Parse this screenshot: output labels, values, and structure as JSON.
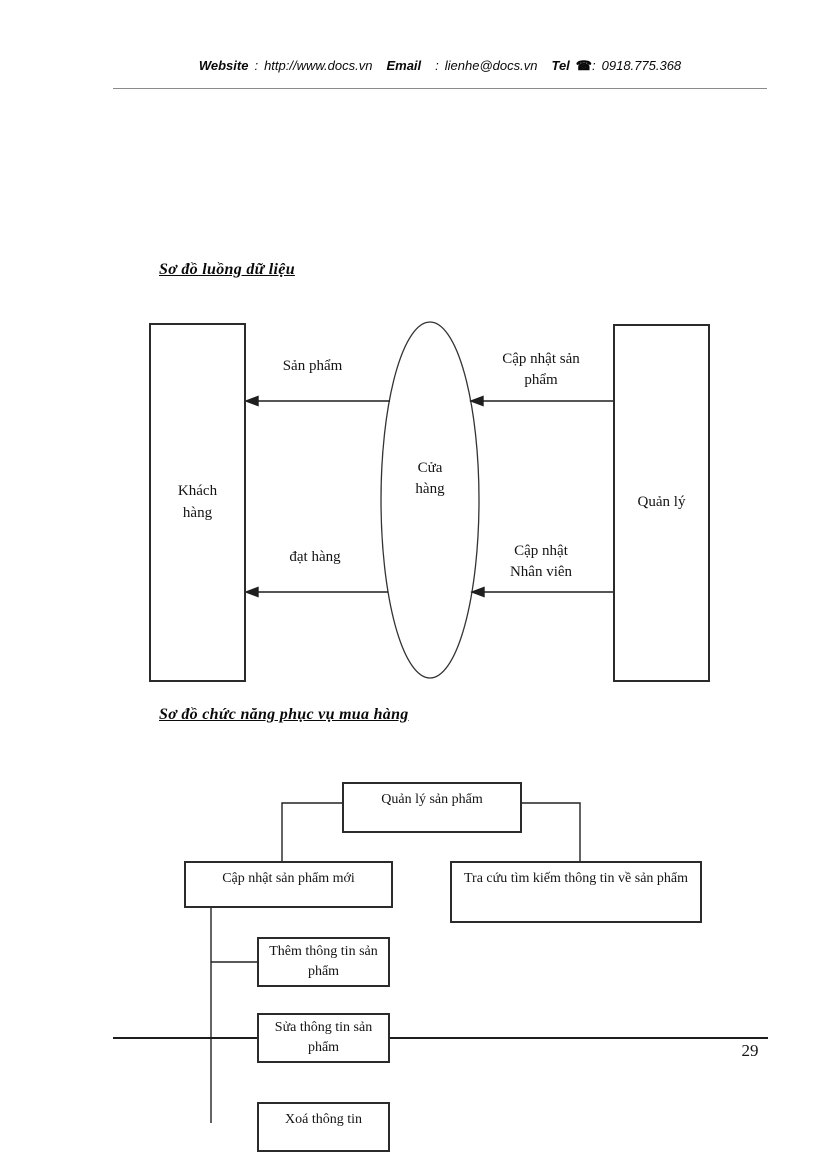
{
  "header": {
    "website_label": "Website",
    "website_sep": ":",
    "website_value": "http://www.docs.vn",
    "email_label": "Email",
    "email_sep": ":",
    "email_value": "lienhe@docs.vn",
    "tel_label": "Tel",
    "phone_icon": "☎",
    "tel_sep": ":",
    "tel_value": "0918.775.368"
  },
  "dfd": {
    "title": "Sơ đồ luồng dữ liệu",
    "entities": {
      "customer": "Khách hàng",
      "store": "Cửa hàng",
      "manager": "Quản lý"
    },
    "flows": {
      "top_left": "Sản phẩm",
      "top_right": "Cập nhật sản phẩm",
      "bottom_left": "đạt hàng",
      "bottom_right": "Cập nhật Nhân viên"
    }
  },
  "func_chart": {
    "title": "Sơ đồ chức năng phục vụ mua hàng",
    "root": "Quản lý sản phẩm",
    "children": {
      "update": "Cập nhật sản phẩm mới",
      "search": "Tra cứu tìm kiếm thông tin về sản phẩm"
    },
    "update_children": {
      "add": "Thêm thông tin sản phẩm",
      "edit": "Sửa thông tin sản phẩm",
      "delete": "Xoá thông tin"
    }
  },
  "footer": {
    "page_number": "29"
  }
}
